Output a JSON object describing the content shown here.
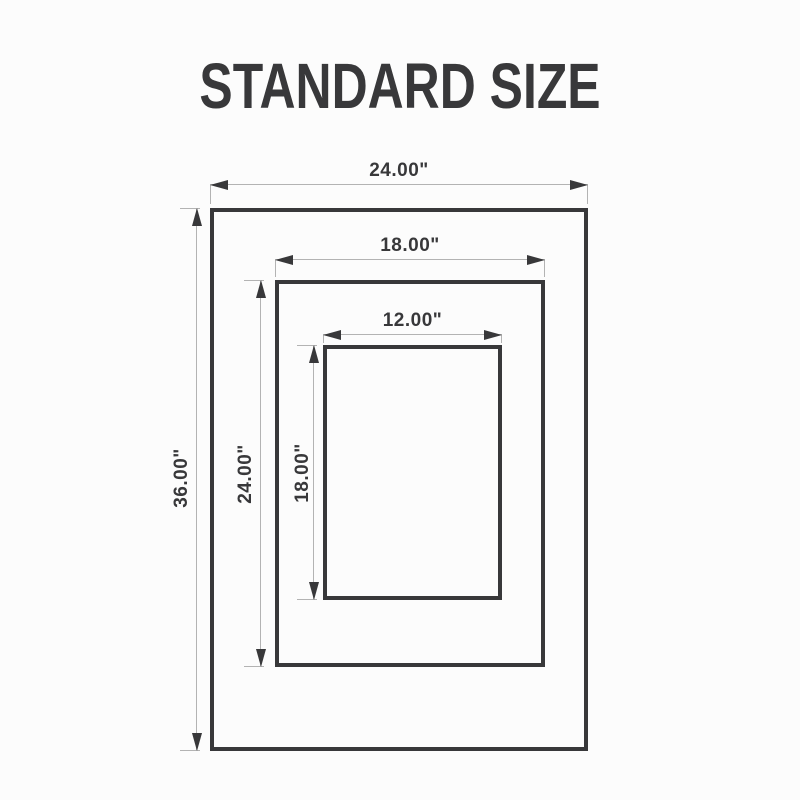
{
  "title": "STANDARD SIZE",
  "colors": {
    "background": "#fcfcfc",
    "dark": "#38383a",
    "light_line": "#b3b3b3"
  },
  "frames": {
    "outer": {
      "width_label": "24.00\"",
      "height_label": "36.00\""
    },
    "middle": {
      "width_label": "18.00\"",
      "height_label": "24.00\""
    },
    "inner": {
      "width_label": "12.00\"",
      "height_label": "18.00\""
    }
  }
}
